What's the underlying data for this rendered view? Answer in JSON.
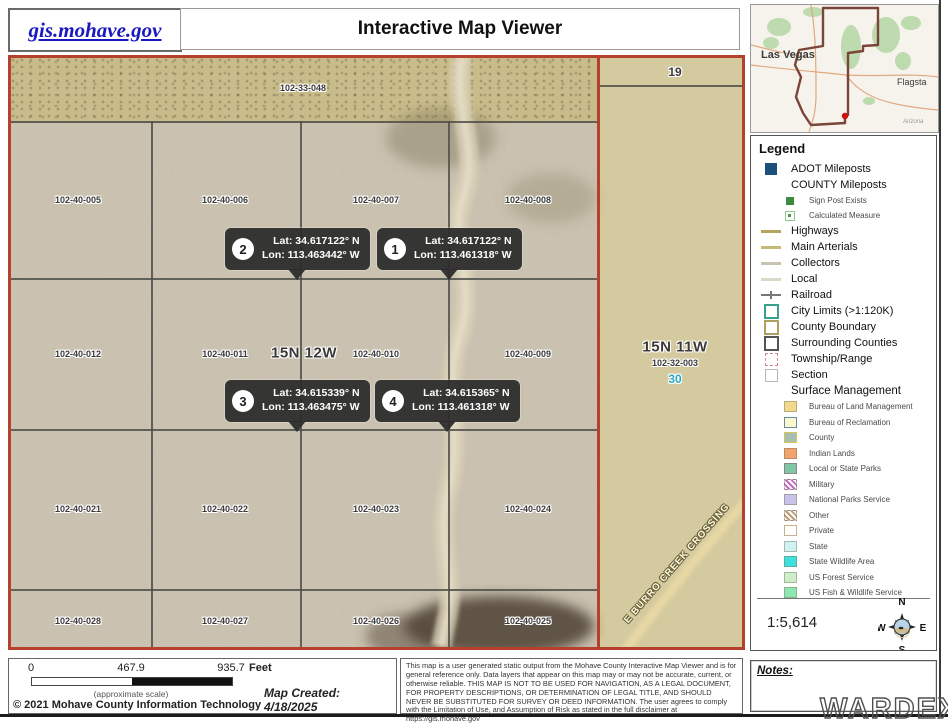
{
  "header": {
    "logo": "gis.mohave.gov",
    "title": "Interactive Map Viewer"
  },
  "colors": {
    "map_border": "#b5402c",
    "link": "#1a18c0",
    "section_number": "#2aa8c4"
  },
  "overview": {
    "city": "Las Vegas",
    "city2": "Flagsta",
    "attribution": "Arizona"
  },
  "map": {
    "townships": {
      "west": "15N 12W",
      "east": "15N 11W"
    },
    "sections": {
      "n19": "19",
      "n30": "30"
    },
    "parcels": {
      "top": "102-33-048",
      "row1": [
        "102-40-005",
        "102-40-006",
        "102-40-007",
        "102-40-008"
      ],
      "row2": [
        "102-40-012",
        "102-40-011",
        "102-40-010",
        "102-40-009"
      ],
      "row3": [
        "102-40-021",
        "102-40-022",
        "102-40-023",
        "102-40-024"
      ],
      "row4": [
        "102-40-028",
        "102-40-027",
        "102-40-026",
        "102-40-025"
      ],
      "east": "102-32-003"
    },
    "road": "E BURRO CREEK CROSSING",
    "callouts": [
      {
        "num": "1",
        "lat": "Lat: 34.617122° N",
        "lon": "Lon: 113.461318° W"
      },
      {
        "num": "2",
        "lat": "Lat: 34.617122° N",
        "lon": "Lon: 113.463442° W"
      },
      {
        "num": "3",
        "lat": "Lat: 34.615339° N",
        "lon": "Lon: 113.463475° W"
      },
      {
        "num": "4",
        "lat": "Lat: 34.615365° N",
        "lon": "Lon: 113.461318° W"
      }
    ]
  },
  "legend": {
    "title": "Legend",
    "items": [
      {
        "label": "ADOT Mileposts",
        "color": "#1c4f7c"
      },
      {
        "label": "COUNTY Mileposts"
      },
      {
        "label": "Sign Post Exists",
        "color": "#3d8c3d"
      },
      {
        "label": "Calculated Measure",
        "color": "#8cc88c"
      },
      {
        "label": "Highways",
        "color": "#b3a55d"
      },
      {
        "label": "Main Arterials",
        "color": "#c6ba78"
      },
      {
        "label": "Collectors",
        "color": "#c9c4b2"
      },
      {
        "label": "Local",
        "color": "#dcd8c9"
      },
      {
        "label": "Railroad",
        "color": "#787878"
      },
      {
        "label": "City Limits (>1:120K)",
        "color": "#3aa08e"
      },
      {
        "label": "County Boundary",
        "color": "#b0a060"
      },
      {
        "label": "Surrounding Counties",
        "color": "#555555"
      },
      {
        "label": "Township/Range",
        "color": "#cc8a8a"
      },
      {
        "label": "Section",
        "color": "#b8b8b8"
      },
      {
        "label": "Surface Management"
      }
    ],
    "surface": [
      {
        "label": "Bureau of Land Management",
        "color": "#f2d98c"
      },
      {
        "label": "Bureau of Reclamation",
        "color": "#fdf9cf",
        "border": "#6888a8"
      },
      {
        "label": "County",
        "color": "#a9bdb1",
        "border": "#d2c95a"
      },
      {
        "label": "Indian Lands",
        "color": "#f2a36e"
      },
      {
        "label": "Local or State Parks",
        "color": "#82c7a5",
        "border": "#888888"
      },
      {
        "label": "Military",
        "color": "#b864b8"
      },
      {
        "label": "National Parks Service",
        "color": "#c9c3ea"
      },
      {
        "label": "Other",
        "color": "#b89878"
      },
      {
        "label": "Private",
        "color": "#ffffff",
        "border": "#c5b190"
      },
      {
        "label": "State",
        "color": "#cff2f2"
      },
      {
        "label": "State Wildlife Area",
        "color": "#3fe0dc"
      },
      {
        "label": "US Forest Service",
        "color": "#cdeec8"
      },
      {
        "label": "US Fish & Wildlife Service",
        "color": "#8fe8b4"
      }
    ],
    "scale_ratio": "1:5,614",
    "compass": {
      "n": "N",
      "e": "E",
      "s": "S",
      "w": "W"
    }
  },
  "scalebar": {
    "t0": "0",
    "t1": "467.9",
    "t2": "935.7",
    "unit": "Feet",
    "approx": "(approximate scale)",
    "created": "Map Created: 4/18/2025",
    "copyright": "© 2021 Mohave County Information Technology"
  },
  "disclaimer": "This map is a user generated static output from the Mohave County Interactive Map Viewer and is for general reference only. Data layers that appear on this map may or may not be accurate, current, or otherwise reliable. THIS MAP IS NOT TO BE USED FOR NAVIGATION, AS A LEGAL DOCUMENT, FOR PROPERTY DESCRIPTIONS, OR DETERMINATION OF LEGAL TITLE, AND SHOULD NEVER BE SUBSTITUTED FOR SURVEY OR DEED INFORMATION. The user agrees to comply with the Limitation of Use, and Assumption of Risk as stated in the full disclaimer at https://gis.mohave.gov",
  "notes_label": "Notes:",
  "watermark": "WARDEX"
}
